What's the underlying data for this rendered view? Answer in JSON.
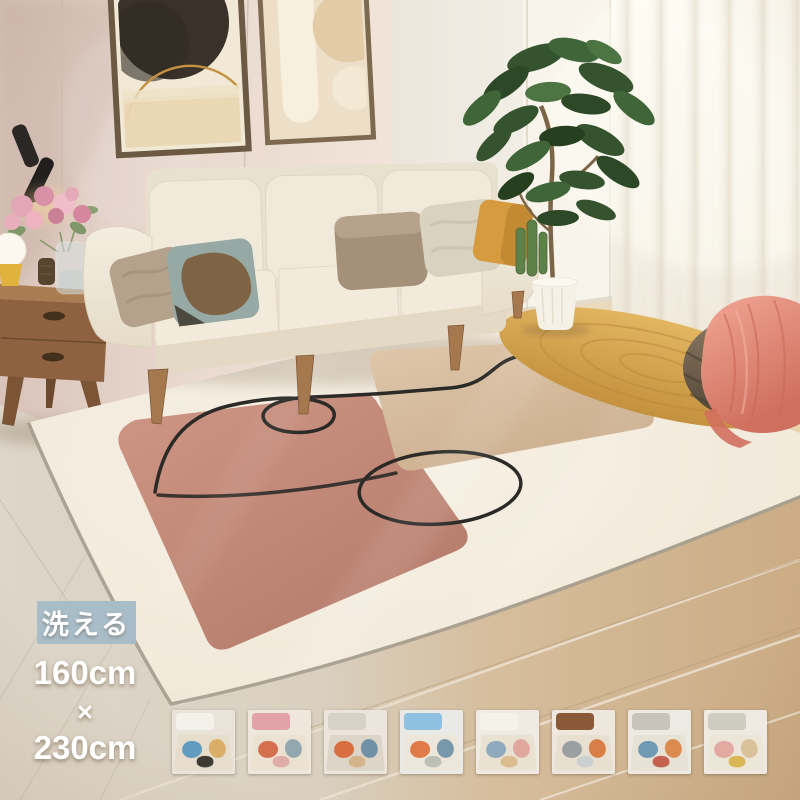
{
  "overlay": {
    "badge": {
      "label": "洗える",
      "bg_color": "#a9bdc9",
      "text_color": "#ffffff"
    },
    "size": {
      "line1": "160cm",
      "line2": "×",
      "line3": "230cm",
      "text_color": "#ffffff"
    }
  },
  "scene": {
    "colors": {
      "wall_warm": "#e8d7cd",
      "wall_light": "#f2ede4",
      "curtain": "#f8f4eb",
      "floor_left": "#dbd3c5",
      "floor_right": "#d2b795",
      "rug_base": "#f3ecdf",
      "rug_rose": "#c58b79",
      "rug_tan": "#d7bc9f",
      "rug_line": "#2b2a27",
      "sofa": "#efe8d9",
      "pillow_mustard": "#d79b3f",
      "jute_mat": "#d8a852",
      "rattan_pouf": "#7a6a55",
      "blanket_pink": "#e2897c",
      "plant_green": "#35532f",
      "table_wood": "#9c6f47",
      "frame_art_dark": "#3a322a",
      "frame_art_gold": "#c49140",
      "roses_pink": "#dd9cae"
    }
  },
  "thumbnails": [
    {
      "name": "rug-variant-1",
      "palette": {
        "wall": "#eae3da",
        "furn": "#f4f1ea",
        "rug": "#e6ddcc",
        "a1": "#5f9cbf",
        "a2": "#d9ae66",
        "a3": "#2e2b26"
      }
    },
    {
      "name": "rug-variant-2",
      "palette": {
        "wall": "#efe6dc",
        "furn": "#e2a3a8",
        "rug": "#ece2d2",
        "a1": "#d4704e",
        "a2": "#93a7b0",
        "a3": "#dca8a4"
      }
    },
    {
      "name": "rug-variant-3",
      "palette": {
        "wall": "#ebe5dd",
        "furn": "#d8d2c6",
        "rug": "#ddd6c8",
        "a1": "#d96f41",
        "a2": "#6f90a6",
        "a3": "#d2b184"
      }
    },
    {
      "name": "rug-variant-4",
      "palette": {
        "wall": "#e9e9e6",
        "furn": "#8fc0e0",
        "rug": "#ece7da",
        "a1": "#e07b49",
        "a2": "#7797ab",
        "a3": "#b9bdb3"
      }
    },
    {
      "name": "rug-variant-5",
      "palette": {
        "wall": "#efeae2",
        "furn": "#f5f2ea",
        "rug": "#e9e2d2",
        "a1": "#8fa9bd",
        "a2": "#dfa79e",
        "a3": "#d8b888"
      }
    },
    {
      "name": "rug-variant-6",
      "palette": {
        "wall": "#ede7de",
        "furn": "#8a5a38",
        "rug": "#e7e0d1",
        "a1": "#9aa0a2",
        "a2": "#d87f47",
        "a3": "#c9cfd0"
      }
    },
    {
      "name": "rug-variant-7",
      "palette": {
        "wall": "#edeae3",
        "furn": "#c8c4bb",
        "rug": "#e7e2d6",
        "a1": "#6f9ab2",
        "a2": "#dc8a4e",
        "a3": "#c25743"
      }
    },
    {
      "name": "rug-variant-8",
      "palette": {
        "wall": "#eeeae2",
        "furn": "#cecbc1",
        "rug": "#ebe6d8",
        "a1": "#e2aaa1",
        "a2": "#d9c299",
        "a3": "#d8b24a"
      }
    }
  ]
}
